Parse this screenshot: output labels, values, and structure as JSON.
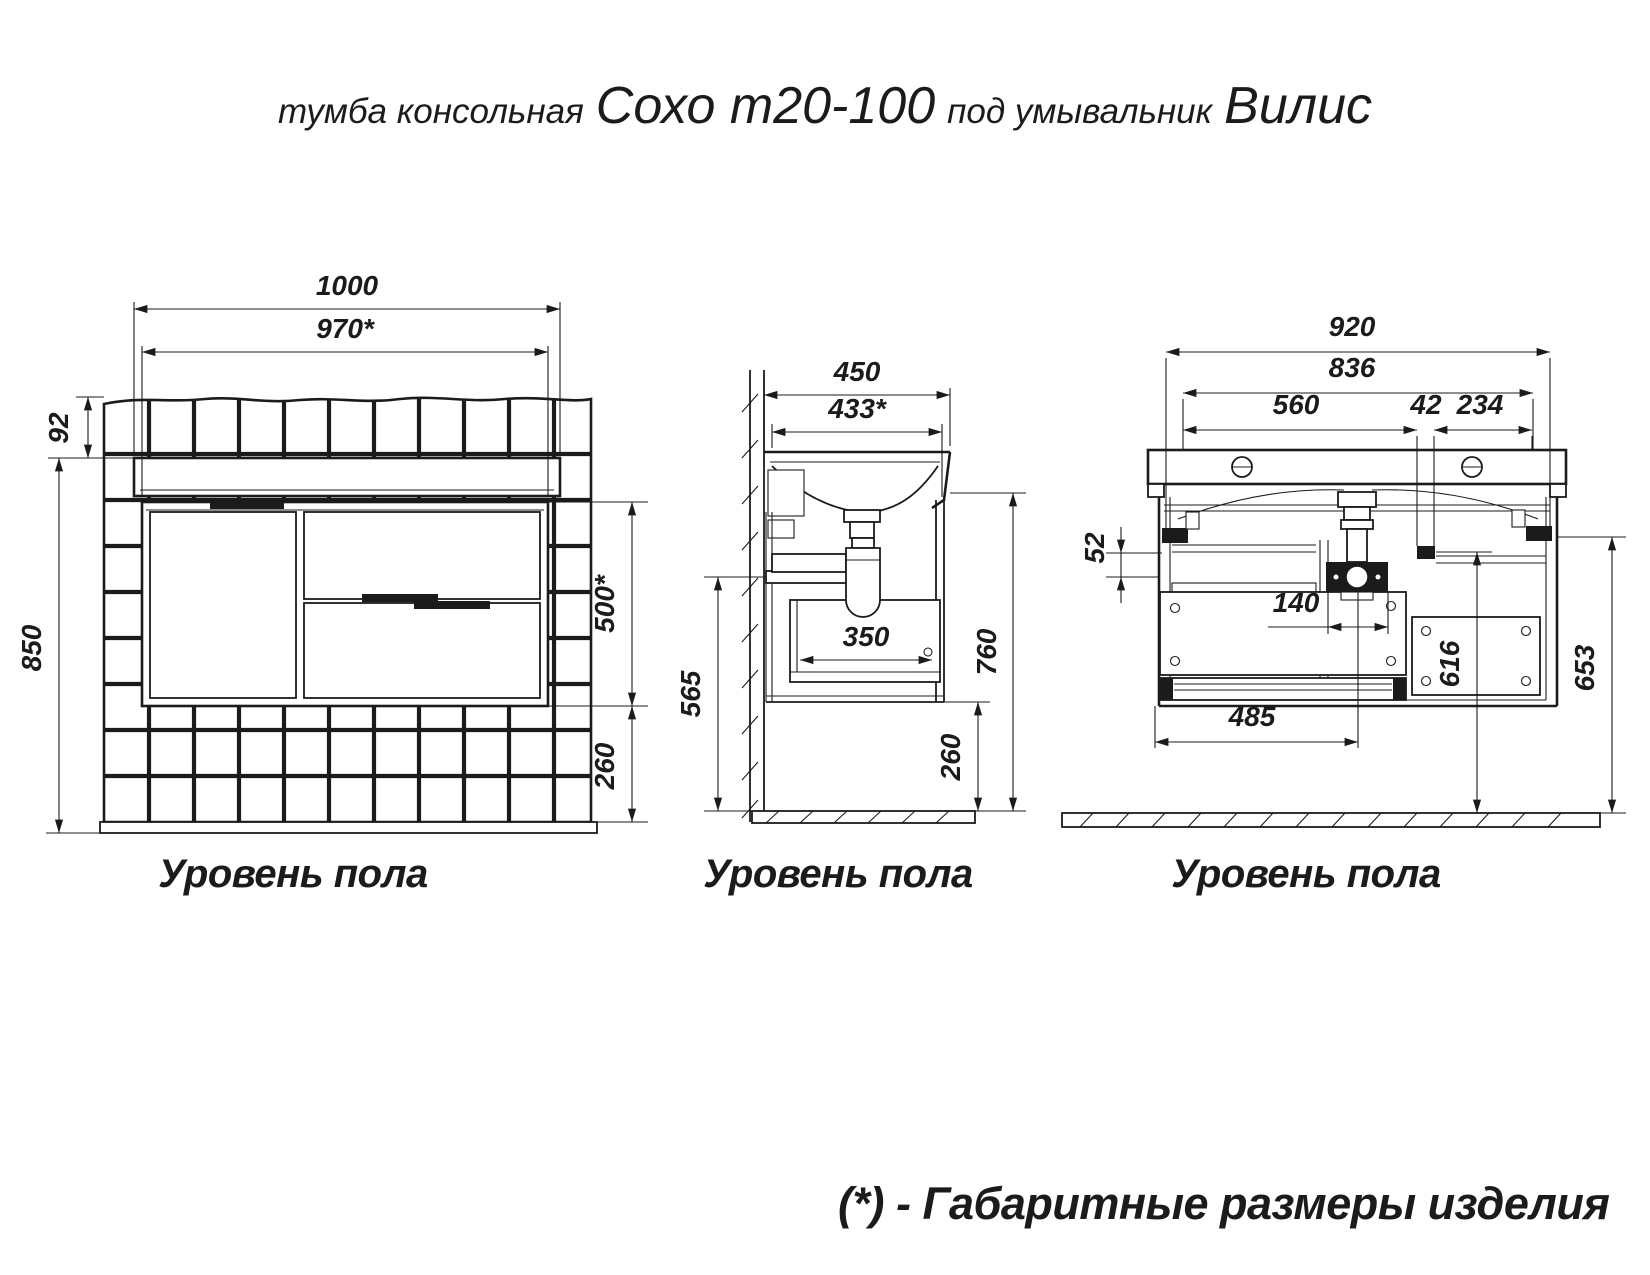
{
  "title": {
    "prefix": "тумба консольная",
    "model": "Сохо т20-100",
    "middle": "под умывальник",
    "basin": "Вилис"
  },
  "footnote": "(*) - Габаритные размеры изделия",
  "floor_label": "Уровень пола",
  "dims": {
    "front": {
      "total_width": "1000",
      "product_width": "970*",
      "top_offset": "92",
      "mount_height": "850",
      "cabinet_height": "500*",
      "floor_clearance": "260"
    },
    "side": {
      "total_depth": "450",
      "product_depth": "433*",
      "drawer_inner_depth": "350",
      "clearance_height": "565",
      "total_height": "760",
      "floor_clearance": "260"
    },
    "back": {
      "basin_width": "920",
      "mount_width": "836",
      "drain_left": "560",
      "bracket_gap": "42",
      "drain_right": "234",
      "rail_offset": "52",
      "trap_width": "140",
      "drain_offset": "485",
      "rail_height": "616",
      "bracket_height": "653"
    }
  }
}
